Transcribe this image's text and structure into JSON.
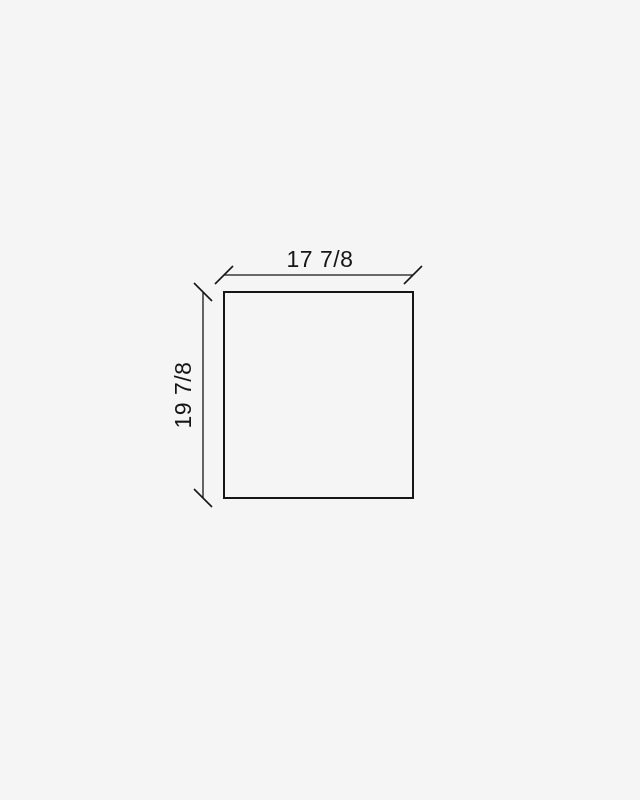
{
  "page": {
    "background_color": "#f5f5f5"
  },
  "diagram": {
    "type": "dimensioned-rectangle-drawing",
    "shape": "rectangle-outline",
    "dimensions": {
      "width_label": "17 7/8",
      "height_label": "19 7/8"
    },
    "colors": {
      "line": "#161616",
      "text": "#161616",
      "background": "#f5f5f5"
    }
  }
}
